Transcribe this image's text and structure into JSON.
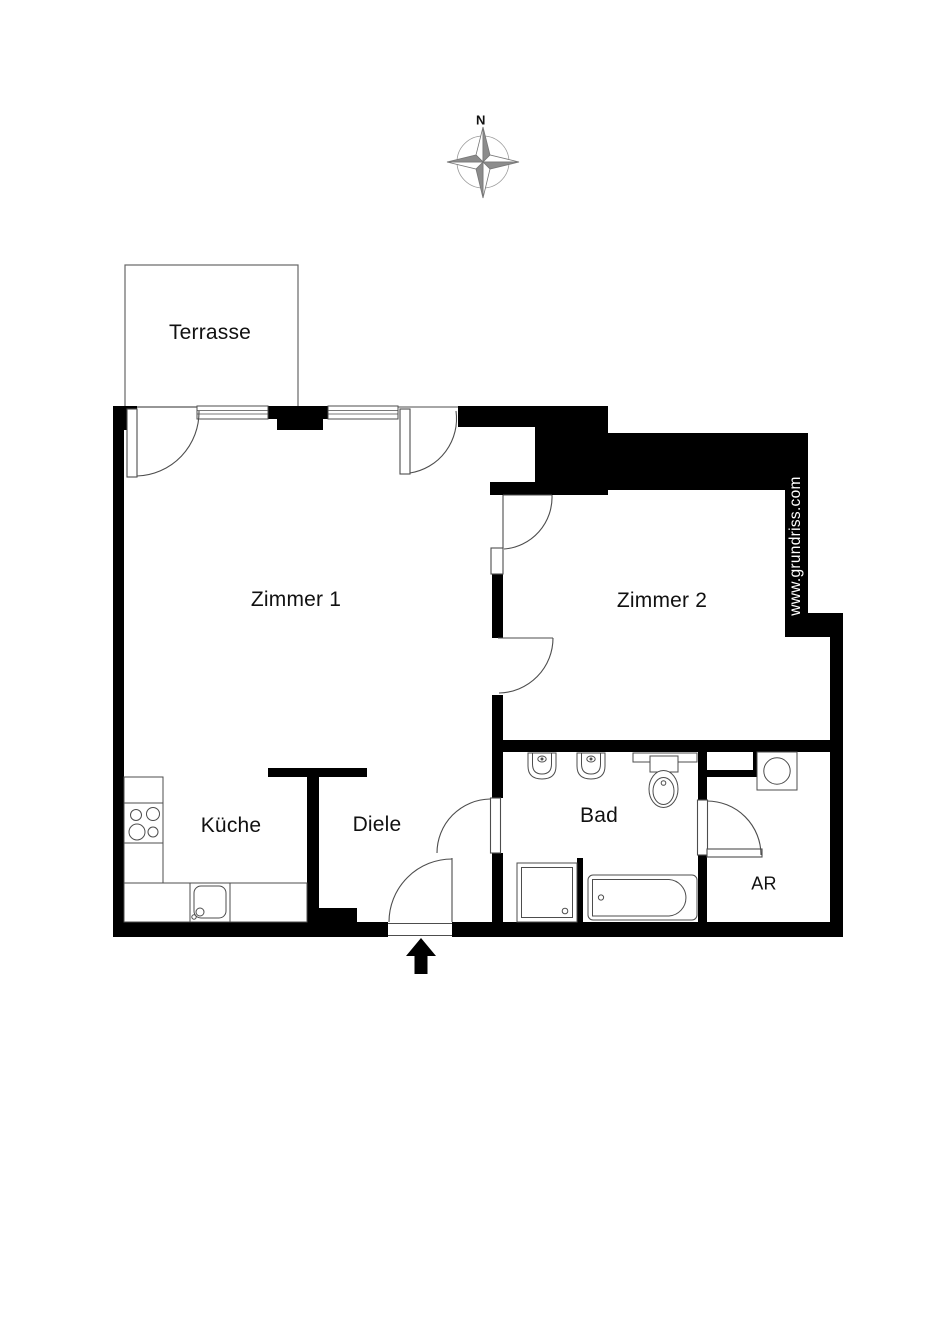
{
  "compass": {
    "label": "N"
  },
  "watermark": {
    "text": "www.grundriss.com",
    "color": "#ffffff"
  },
  "rooms": {
    "terrasse": {
      "label": "Terrasse"
    },
    "zimmer1": {
      "label": "Zimmer 1"
    },
    "zimmer2": {
      "label": "Zimmer 2"
    },
    "kueche": {
      "label": "Küche"
    },
    "diele": {
      "label": "Diele"
    },
    "bad": {
      "label": "Bad"
    },
    "ar": {
      "label": "AR"
    }
  },
  "fixtures": [
    "compass-rose-icon",
    "entrance-arrow-icon",
    "stove-icon",
    "kitchen-sink-icon",
    "washbasin-icon",
    "toilet-icon",
    "shower-icon",
    "bathtub-icon",
    "washing-machine-icon"
  ],
  "colors": {
    "wall": "#000000",
    "background": "#ffffff",
    "fixture_line": "#4d4d4d",
    "terrace_line": "#666666",
    "compass_gray": "#8c8c8c",
    "watermark_text": "#ffffff"
  }
}
